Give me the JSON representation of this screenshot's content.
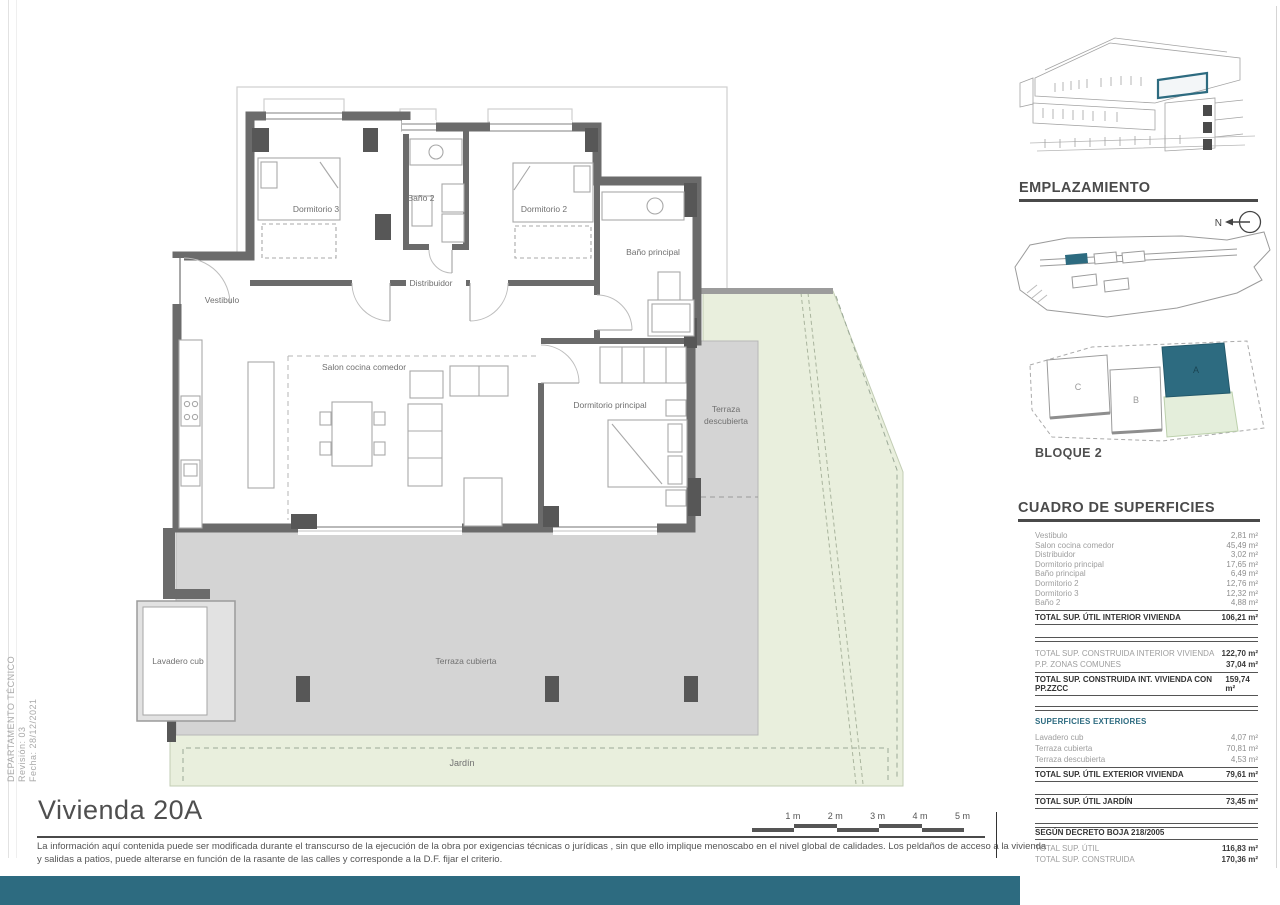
{
  "page": {
    "title": "Vivienda 20A",
    "disclaimer_line1": "La información aquí contenida puede ser modificada durante el transcurso de la ejecución de la obra por exigencias técnicas o jurídicas , sin que ello implique menoscabo en el nivel global de calidades. Los peldaños de acceso a la vivienda",
    "disclaimer_line2": "y salidas a patios, puede alterarse en función de la rasante de las calles y corresponde a  la D.F. fijar el criterio.",
    "side_text": {
      "line1": "DEPARTAMENTO TÉCNICO",
      "line2": "Revisión:  03",
      "line3": "Fecha: 28/12/2021"
    }
  },
  "colors": {
    "accent_teal": "#2d6b80",
    "wall_gray": "#6b6b6b",
    "terrace_gray": "#d4d4d4",
    "garden_green": "#e9efdd"
  },
  "plan": {
    "rooms": {
      "vestibulo": "Vestibulo",
      "dormitorio3": "Dormitorio 3",
      "bano2": "Baño 2",
      "dormitorio2": "Dormitorio 2",
      "bano_principal": "Baño principal",
      "distribuidor": "Distribuidor",
      "salon": "Salon cocina comedor",
      "dormitorio_principal": "Dormitorio principal",
      "terraza_descubierta_line1": "Terraza",
      "terraza_descubierta_line2": "descubierta",
      "lavadero": "Lavadero cub",
      "terraza_cubierta": "Terraza cubierta",
      "jardin": "Jardín"
    },
    "scale_labels": [
      "1 m",
      "2 m",
      "3 m",
      "4 m",
      "5 m"
    ]
  },
  "sidebar": {
    "emplazamiento_title": "EMPLAZAMIENTO",
    "north_label": "N",
    "bloque_label": "BLOQUE 2",
    "block_letters": [
      "C",
      "B",
      "A"
    ],
    "table_title": "CUADRO DE SUPERFICIES",
    "interior_rows": [
      {
        "label": "Vestibulo",
        "value": "2,81 m²"
      },
      {
        "label": "Salon cocina comedor",
        "value": "45,49 m²"
      },
      {
        "label": "Distribuidor",
        "value": "3,02 m²"
      },
      {
        "label": "Dormitorio principal",
        "value": "17,65 m²"
      },
      {
        "label": "Baño principal",
        "value": "6,49 m²"
      },
      {
        "label": "Dormitorio 2",
        "value": "12,76 m²"
      },
      {
        "label": "Dormitorio 3",
        "value": "12,32 m²"
      },
      {
        "label": "Baño 2",
        "value": "4,88 m²"
      }
    ],
    "interior_total": {
      "label": "TOTAL SUP. ÚTIL INTERIOR VIVIENDA",
      "value": "106,21 m²"
    },
    "construida_rows": [
      {
        "label": "TOTAL SUP. CONSTRUIDA INTERIOR VIVIENDA",
        "value": "122,70 m²"
      },
      {
        "label": "P.P. ZONAS COMUNES",
        "value": "37,04 m²"
      }
    ],
    "construida_total": {
      "label": "TOTAL SUP. CONSTRUIDA INT. VIVIENDA CON PP.ZZCC",
      "value": "159,74 m²"
    },
    "exteriores_title": "SUPERFICIES EXTERIORES",
    "exterior_rows": [
      {
        "label": "Lavadero cub",
        "value": "4,07 m²"
      },
      {
        "label": "Terraza cubierta",
        "value": "70,81 m²"
      },
      {
        "label": "Terraza descubierta",
        "value": "4,53 m²"
      }
    ],
    "exterior_total": {
      "label": "TOTAL SUP. ÚTIL EXTERIOR VIVIENDA",
      "value": "79,61 m²"
    },
    "jardin_total": {
      "label": "TOTAL SUP. ÚTIL JARDÍN",
      "value": "73,45 m²"
    },
    "decreto_title": "SEGÚN DECRETO BOJA 218/2005",
    "decreto_rows": [
      {
        "label": "TOTAL SUP. ÚTIL",
        "value": "116,83 m²"
      },
      {
        "label": "TOTAL SUP. CONSTRUIDA",
        "value": "170,36 m²"
      }
    ]
  }
}
